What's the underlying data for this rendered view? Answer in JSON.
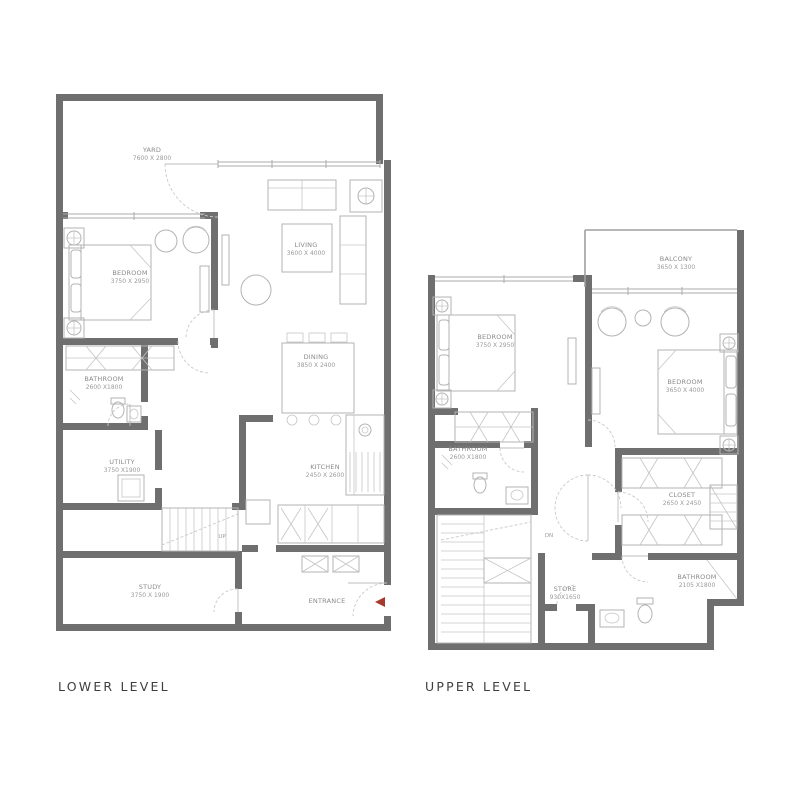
{
  "colors": {
    "background": "#ffffff",
    "wall": "#6f6f6f",
    "thin_line": "#b3b3b3",
    "window_line": "#ababab",
    "dashed_door": "#c9c9c9",
    "label_text": "#8a8a8a",
    "caption_text": "#3e3e3e",
    "entrance_arrow_red": "#a63a2e"
  },
  "lower": {
    "caption": "LOWER LEVEL",
    "rooms": {
      "yard": {
        "name": "YARD",
        "dims": "7600 X 2800"
      },
      "bedroom": {
        "name": "BEDROOM",
        "dims": "3750 X 2950"
      },
      "living": {
        "name": "LIVING",
        "dims": "3600 X 4000"
      },
      "dining": {
        "name": "DINING",
        "dims": "3850 X 2400"
      },
      "bathroom": {
        "name": "BATHROOM",
        "dims": "2600 X1800"
      },
      "utility": {
        "name": "UTILITY",
        "dims": "3750 X1900"
      },
      "kitchen": {
        "name": "KITCHEN",
        "dims": "2450 X 2600"
      },
      "study": {
        "name": "STUDY",
        "dims": "3750 X 1900"
      },
      "entrance": {
        "name": "ENTRANCE"
      },
      "up": {
        "name": "UP"
      }
    }
  },
  "upper": {
    "caption": "UPPER LEVEL",
    "rooms": {
      "balcony": {
        "name": "BALCONY",
        "dims": "3650 X 1300"
      },
      "bedroom1": {
        "name": "BEDROOM",
        "dims": "3750 X 2950"
      },
      "bedroom2": {
        "name": "BEDROOM",
        "dims": "3650 X 4000"
      },
      "bathroom1": {
        "name": "BATHROOM",
        "dims": "2600 X1800"
      },
      "closet": {
        "name": "CLOSET",
        "dims": "2650 X 2450"
      },
      "bathroom2": {
        "name": "BATHROOM",
        "dims": "2105 X1800"
      },
      "store": {
        "name": "STORE",
        "dims": "930X1650"
      },
      "dn": {
        "name": "DN"
      }
    }
  }
}
